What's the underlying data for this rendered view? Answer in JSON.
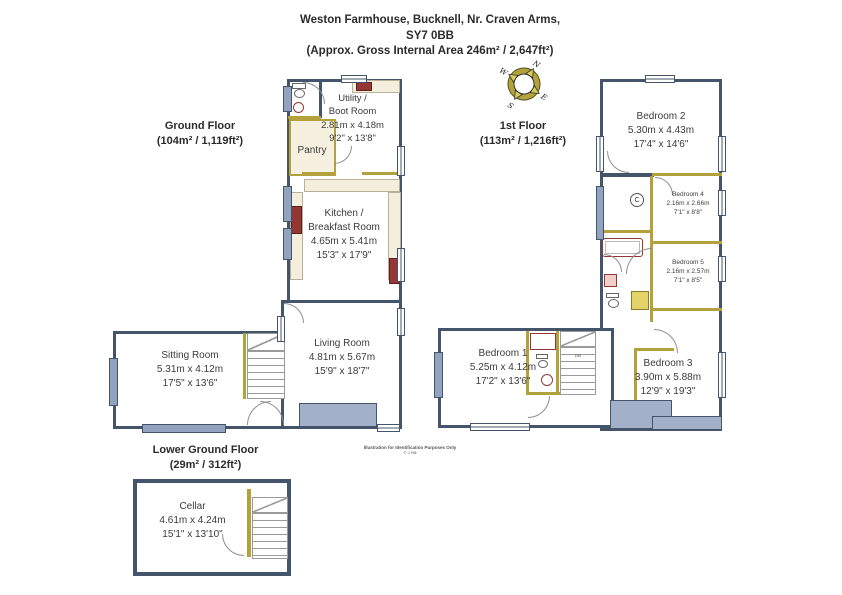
{
  "title": {
    "line1": "Weston Farmhouse, Bucknell, Nr. Craven Arms,",
    "line2": "SY7 0BB",
    "line3": "(Approx. Gross Internal Area 246m² / 2,647ft²)"
  },
  "floors": {
    "ground": {
      "label": "Ground Floor",
      "area": "(104m² / 1,119ft²)"
    },
    "first": {
      "label": "1st Floor",
      "area": "(113m² / 1,216ft²)"
    },
    "lower": {
      "label": "Lower Ground Floor",
      "area": "(29m² / 312ft²)"
    }
  },
  "rooms": {
    "utility": {
      "line1": "Utility /",
      "line2": "Boot Room",
      "dims_m": "2.81m x 4.18m",
      "dims_ft": "9'2\" x 13'8\""
    },
    "pantry": {
      "name": "Pantry"
    },
    "kitchen": {
      "line1": "Kitchen /",
      "line2": "Breakfast Room",
      "dims_m": "4.65m x 5.41m",
      "dims_ft": "15'3\" x 17'9\""
    },
    "living": {
      "name": "Living Room",
      "dims_m": "4.81m x 5.67m",
      "dims_ft": "15'9\" x 18'7\""
    },
    "sitting": {
      "name": "Sitting Room",
      "dims_m": "5.31m x 4.12m",
      "dims_ft": "17'5\" x 13'6\""
    },
    "cellar": {
      "name": "Cellar",
      "dims_m": "4.61m x 4.24m",
      "dims_ft": "15'1\" x 13'10\""
    },
    "bedroom1": {
      "name": "Bedroom 1",
      "dims_m": "5.25m x 4.12m",
      "dims_ft": "17'2\" x 13'6\""
    },
    "bedroom2": {
      "name": "Bedroom 2",
      "dims_m": "5.30m x 4.43m",
      "dims_ft": "17'4\" x 14'6\""
    },
    "bedroom3": {
      "name": "Bedroom 3",
      "dims_m": "3.90m x 5.88m",
      "dims_ft": "12'9\" x 19'3\""
    },
    "bedroom4": {
      "name": "Bedroom 4",
      "dims_m": "2.16m x 2.66m",
      "dims_ft": "7'1\" x 8'8\""
    },
    "bedroom5": {
      "name": "Bedroom 5",
      "dims_m": "2.16m x 2.57m",
      "dims_ft": "7'1\" x 8'5\""
    }
  },
  "compass": {
    "n": "N",
    "e": "E",
    "s": "S",
    "w": "W"
  },
  "annotations": {
    "cupboard": "C",
    "stairs_down": "DN",
    "disclaimer1": "Illustration for Identification Purposes Only",
    "disclaimer2": "© J Hill"
  },
  "colors": {
    "wall": "#44546a",
    "window_fill": "#92a3c0",
    "interior_wall": "#b3a23c",
    "counter": "#f4eedd",
    "appliance": "#943634",
    "shower": "#e3d469",
    "masonry": "#a3b0ca",
    "text": "#3b3b3b"
  }
}
